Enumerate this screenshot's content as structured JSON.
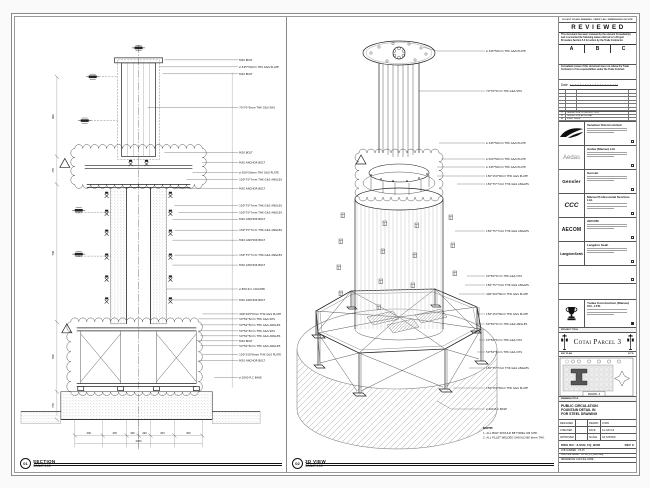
{
  "sheet": {
    "views": {
      "section": {
        "bubble": "01",
        "title": "SECTION",
        "scale": "SCALE 1:10"
      },
      "iso": {
        "bubble": "02",
        "title": "3D VIEW",
        "scale": "SCALE 1:10"
      }
    },
    "section_callouts": [
      "M20 BOLT",
      "ø 345*50mm THK G&S PLATE",
      "M20 BOLT",
      "70*70*5mm THK G&S SHS",
      "M20 BOLT",
      "M20 ANCHOR BOLT",
      "ø 500*50mm THK G&S PLATE",
      "150*75*7mm THK G&S ANGLES",
      "M20 ANCHOR BOLT",
      "150*75*7mm THK G&S ANGLES",
      "150*75*7mm THK G&S ANGLES",
      "M20 ANCHOR BOLT",
      "150*75*7mm THK G&S ANGLES",
      "M20 ANCHOR BOLT",
      "150*75*7mm THK G&S ANGLES",
      "M20 ANCHOR BOLT",
      "ø 850 R.C COLUMN",
      "M20 ANCHOR BOLT",
      "400*200*8mm THK G&S PLATE",
      "50*50*5mm THK G&S SHS",
      "50*50*5mm THK G&S ANGLES",
      "50*50*5mm THK G&S SHS",
      "50*50*5mm THK G&S ANGLES",
      "M20 BOLT",
      "50*50*5mm THK G&S ANGLES",
      "150*150*8mm THK G&S PLATE",
      "M20 ANCHOR BOLT",
      "ø 2000 R.C BASE"
    ],
    "iso_callouts": [
      "ø 345*50mm THK G&S PLATE",
      "70*70*5mm THK G&S SHS",
      "ø 345*50mm THK G&S PLATE",
      "ø 500*50mm THK G&S PLATE",
      "ø 345*50mm THK G&S PLATE",
      "150*150*8mm THK G&S PLATE",
      "150*75*7mm THK G&S ANGLES",
      "150*75*7mm THK G&S ANGLES",
      "50*50*5mm THK G&S CHS",
      "150*75*7mm THK G&S ANGLES",
      "400*200*8mm THK G&S PLATE",
      "150*150*8mm THK G&S PLATE",
      "50*50*5mm THK G&S ANGLES",
      "50*50*5mm THK G&S CHS",
      "50*50*5mm THK G&S CHS",
      "150*75*7mm THK G&S ANGLES",
      "150*150*8mm THK G&S PLATE",
      "ø 200 R.C BASE"
    ],
    "section_dims": {
      "left": [
        "600",
        "750",
        "500",
        "500",
        "750"
      ],
      "bottom": [
        "400",
        "400",
        "400",
        "400",
        "400",
        "400"
      ],
      "bottom_total": "2400"
    },
    "notes": {
      "title": "NOTE:",
      "lines": [
        "1. ALL BOLT SHOULD BE FIXING ON SITE.",
        "2. ALL FILLET WELDED SHOULD BE 6mm THK."
      ]
    }
  },
  "titleblock": {
    "top_note": "DO NOT SCALE DRAWING. VERIFY ALL DIMENSIONS ON SITE",
    "reviewed": {
      "title": "R E V I E W E D",
      "para1": "This document has been reviewed by the relevant Consultant(s) and is accorded the following status referred to in Project Procedure Section 5.4 for action by the Trade Contractor.",
      "statuses": [
        "A",
        "B",
        "C"
      ],
      "para2": "Consultant review of this document does not relieve the Trade Contractor of its responsibilities under the Trade Contract.",
      "date_label": "Date :"
    },
    "revisions": [
      {
        "rev": "C",
        "desc": "ISSUED FOR CONSTRUCTION"
      },
      {
        "rev": "B",
        "desc": "ISSUED FOR APPROVAL"
      },
      {
        "rev": "A",
        "desc": "FIRST ISSUE"
      }
    ],
    "consultants": [
      {
        "logo": "",
        "name": "Venetian Orient Limited"
      },
      {
        "logo": "Aedas",
        "name": "Aedas (Macau) Ltd."
      },
      {
        "logo": "Gensler",
        "name": "Gensler"
      },
      {
        "logo": "CCC",
        "name": "Macau Professional Services Ltd."
      },
      {
        "logo": "AECOM",
        "name": "AECOM"
      },
      {
        "logo": "LangdonSeah",
        "name": "Langdon Seah"
      }
    ],
    "contractor": {
      "name": "Yudea Construction (Macau) CO., LTD."
    },
    "project": {
      "label": "PROJECT TITLE",
      "name": "Cotai Parcel 3"
    },
    "key_plan": {
      "label": "KEY PLAN",
      "scale_note": "N.T.S.",
      "caption": "PARCEL 3"
    },
    "drawing": {
      "label": "DRAWING TITLE",
      "lines": [
        "PUBLIC CIRCULATION",
        "FOUNTAIN DETAIL IN",
        "FOR STEEL DRAWING"
      ]
    },
    "fields": {
      "designed_label": "DESIGNED",
      "designed": "-",
      "drawn_label": "DRAWN",
      "drawn": "CHAN",
      "checked_label": "CHECKED",
      "checked": "-",
      "date_label": "DATE",
      "date": "14-JUN-16",
      "approved_label": "APPROVED",
      "approved": "-",
      "scale_label": "SCALE",
      "scale": "AS SHOWN"
    },
    "dwg": {
      "label": "DWG NO :",
      "value": "3-SUB_FQ_B000",
      "rev_label": "REV",
      "rev": "C"
    },
    "file_rows": [
      {
        "label": "JOB NUMBER :",
        "value": "P3-05"
      },
      {
        "label": "CAD FILE NAME :",
        "value": "COTAI_P3_B000.dwg"
      },
      {
        "label": "REFERENCE CAD FILE NAME :",
        "value": ""
      }
    ]
  }
}
